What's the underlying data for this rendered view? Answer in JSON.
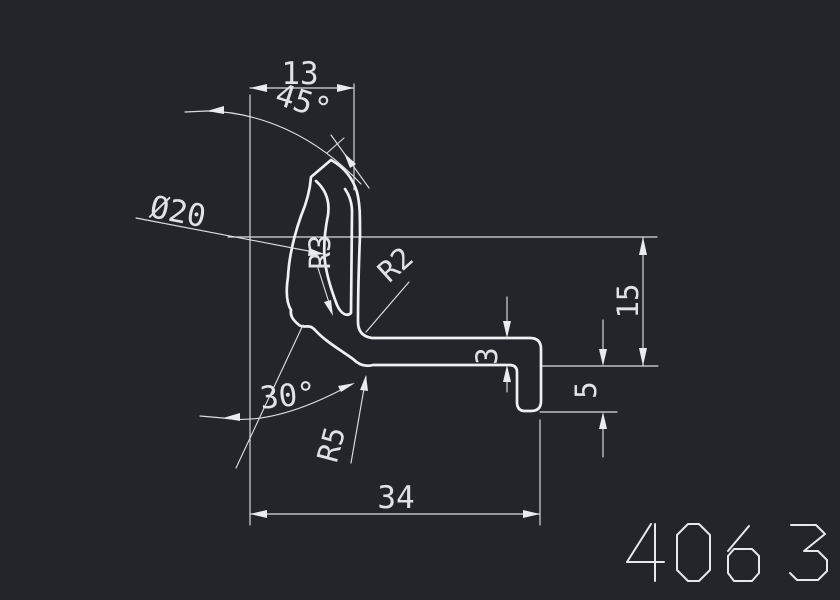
{
  "canvas": {
    "background": "#22262B",
    "line_color": "#EEF0F2",
    "dim_color": "#DFE3E6"
  },
  "drawing": {
    "type": "profile-cross-section",
    "dimensions": {
      "width_top": "13",
      "angle_top": "45°",
      "diameter": "Ø20",
      "radius_groove": "R3",
      "radius_corner": "R2",
      "thickness": "3",
      "height_right": "15",
      "hook_depth": "5",
      "angle_bottom": "30°",
      "radius_bend": "R5",
      "width_bottom": "34"
    },
    "part_number": "4063"
  }
}
